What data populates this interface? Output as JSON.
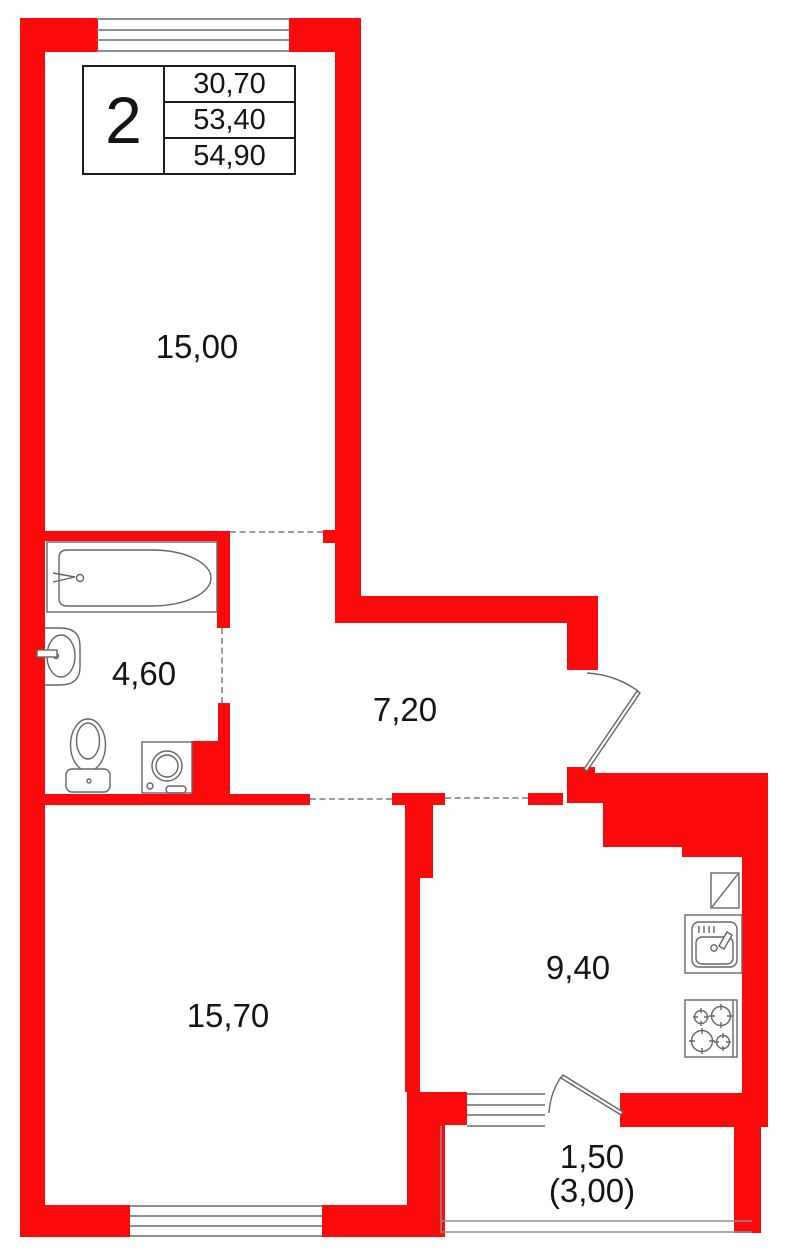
{
  "legend": {
    "rooms_count": "2",
    "areas": [
      "30,70",
      "53,40",
      "54,90"
    ]
  },
  "rooms": {
    "living": {
      "label": "15,00"
    },
    "bathroom": {
      "label": "4,60"
    },
    "hallway": {
      "label": "7,20"
    },
    "bedroom": {
      "label": "15,70"
    },
    "kitchen": {
      "label": "9,40"
    },
    "balcony": {
      "label": "1,50",
      "label_secondary": "(3,00)"
    }
  },
  "colors": {
    "wall": "#fa0a0a",
    "window_line": "#8f8f8f",
    "dashed_opening": "#9b9b9b",
    "fixture_stroke": "#666666",
    "text": "#141414",
    "table_border": "#1c1c1c"
  }
}
